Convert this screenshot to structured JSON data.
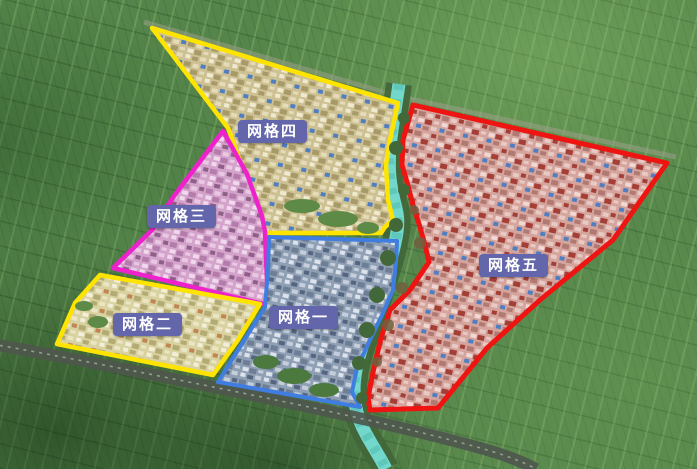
{
  "map": {
    "description": "Oblique aerial map divided into five numbered management grid zones",
    "river_color": "#72d8cc",
    "label_style": {
      "bg_color": "#6366aa",
      "text_color": "#ffffff"
    },
    "zones": [
      {
        "id": "grid-1",
        "label": "网格一",
        "outline_color": "#3f7de0",
        "fill_tint": "#8fa0b5",
        "points": "269,237 397,241 396,262 393,290 383,313 370,340 357,368 352,392 360,407 218,382 265,307 268,270"
      },
      {
        "id": "grid-2",
        "label": "网格二",
        "outline_color": "#ffe400",
        "fill_tint": "#d8d1a0",
        "points": "100,275 260,304 238,340 213,375 57,344 75,303"
      },
      {
        "id": "grid-3",
        "label": "网格三",
        "outline_color": "#ee22cc",
        "fill_tint": "#d4a3cb",
        "points": "223,131 247,174 262,216 265,232 268,305 113,268 153,229 174,196"
      },
      {
        "id": "grid-4",
        "label": "网格四",
        "outline_color": "#ffe400",
        "fill_tint": "#cdc092",
        "points": "152,28 398,103 390,140 386,165 388,200 393,220 385,227 381,233 266,233 228,128"
      },
      {
        "id": "grid-5",
        "label": "网格五",
        "outline_color": "#ee1411",
        "fill_tint": "#d5a59d",
        "points": "413,105 667,163 613,240 540,300 487,348 438,408 370,410 368,398 373,372 381,338 390,310 410,290 429,262 425,245 419,224 413,205 407,182 402,165 403,140"
      }
    ]
  }
}
